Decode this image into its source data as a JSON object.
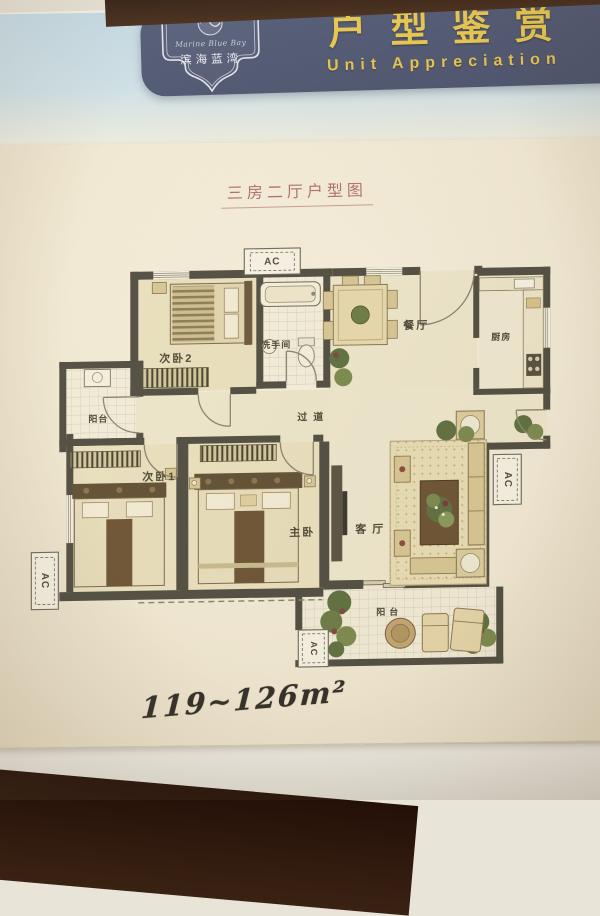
{
  "header": {
    "brand_script": "Marine Blue Bay",
    "brand_cn": "滨海蓝湾",
    "title_cn": "户型鉴赏",
    "title_en": "Unit Appreciation"
  },
  "sheet": {
    "plan_title": "三房二厅户型图",
    "area_text": "119~126m²"
  },
  "floorplan": {
    "ac_label": "AC",
    "rooms": {
      "bed2": "次卧2",
      "bathroom": "洗手间",
      "dining": "餐厅",
      "kitchen": "厨房",
      "balcony_left": "阳台",
      "corridor": "过道",
      "bed1": "次卧1",
      "master": "主卧",
      "living": "客厅",
      "balcony_bottom": "阳台"
    }
  },
  "colors": {
    "band_bg": "#4d5571",
    "gold": "#e9c74e",
    "paper": "#f3ebd6",
    "wall": "#4f4d41",
    "title_red": "#b0706a",
    "ink": "#2f2d27"
  }
}
